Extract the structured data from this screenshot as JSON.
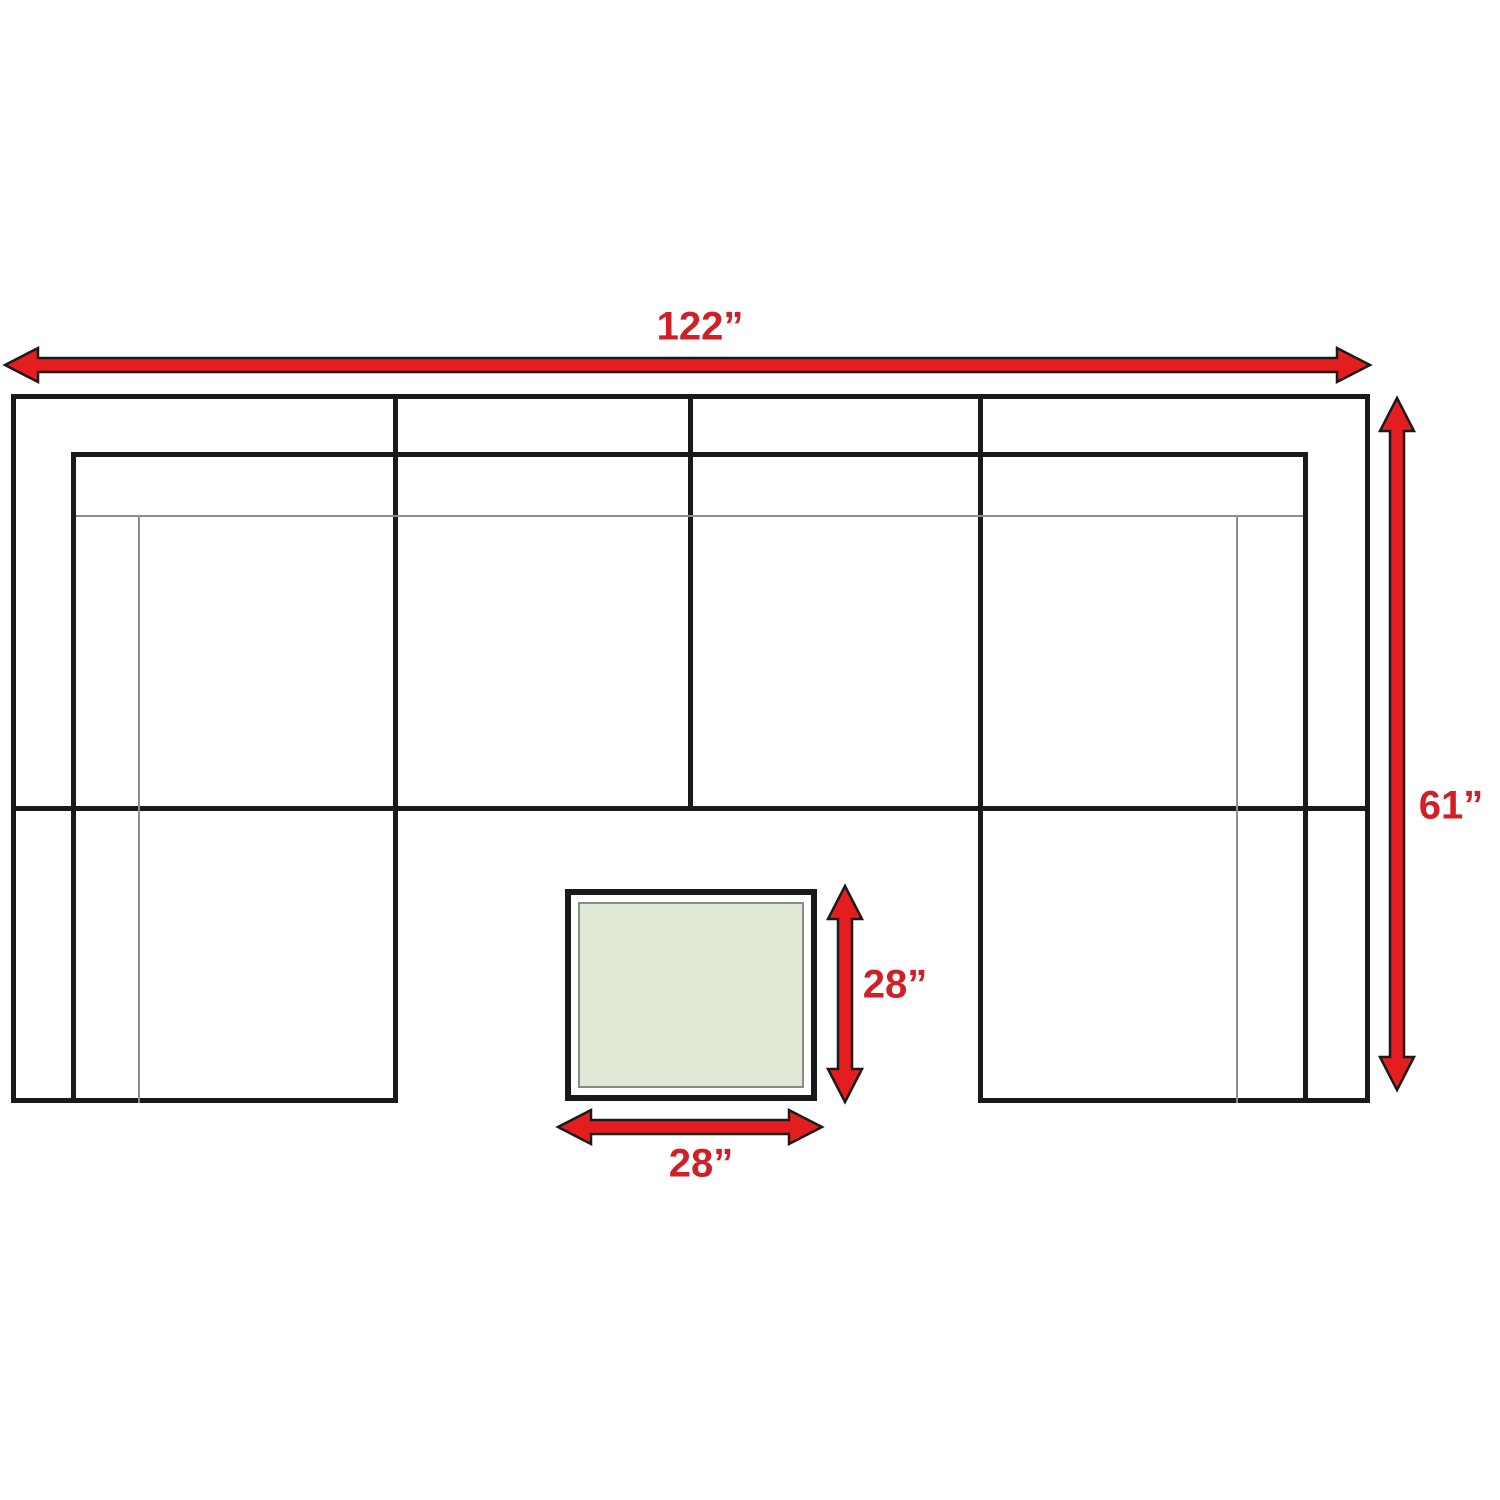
{
  "diagram": {
    "kind": "sectional-sofa-and-table-dimension-diagram",
    "labels": {
      "sofa_width": "122”",
      "sofa_depth": "61”",
      "table_height": "28”",
      "table_width": "28”"
    },
    "colors": {
      "arrow_red": "#e41e1e",
      "label_red": "#d01f26",
      "line_black": "#1a1a1a",
      "line_gray": "#8d8d8d",
      "table_fill": "#dfe9d6",
      "table_border": "#8a8a8a",
      "background": "#ffffff"
    }
  }
}
